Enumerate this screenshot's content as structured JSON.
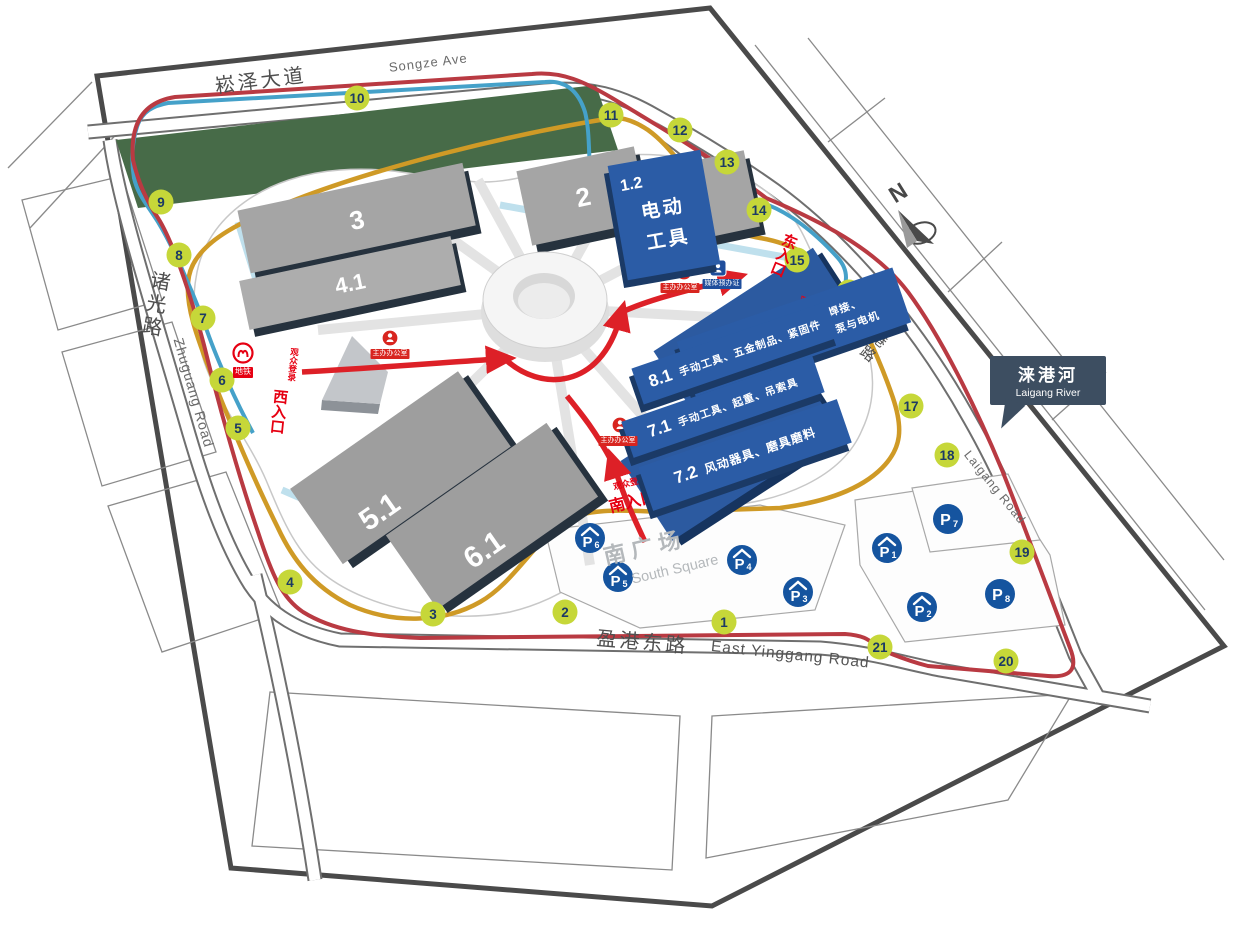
{
  "compass": {
    "n": "N"
  },
  "roads": {
    "songze_zh": "崧泽大道",
    "songze_en": "Songze Ave",
    "zhuguang_zh": "诸光路",
    "zhuguang_en": "Zhuguang Road",
    "yinggang_zh": "盈港东路",
    "yinggang_en": "East Yinggang Road",
    "laigang_zh": "涞港路",
    "laigang_en": "Laigang Road"
  },
  "river_sign": {
    "zh": "涞港河",
    "en": "Laigang River"
  },
  "south_square": {
    "zh": "南广场",
    "en": "South Square"
  },
  "entrances": {
    "west_small": "观众登录",
    "west_big": "西入口",
    "south_small": "观众登录",
    "south_big": "南入口",
    "east_small": "观众登录",
    "east_big": "东入口"
  },
  "halls": {
    "h1": "1",
    "h2": "2",
    "h3": "3",
    "h41": "4.1",
    "h51": "5.1",
    "h61": "6.1",
    "h12_num": "1.2",
    "h12_line1": "电动",
    "h12_line2": "工具",
    "h82_num": "8.2",
    "h82_line1": "电动工具、机械焊接、",
    "h82_line2": "劳保、园林及清洗设备、泵与电机",
    "h81_num": "8.1",
    "h81_text": "手动工具、五金制品、紧固件",
    "h71_num": "7.1",
    "h71_text": "手动工具、起重、吊索具",
    "h72_num": "7.2",
    "h72_text": "风动器具、磨具磨料"
  },
  "route_markers": [
    "1",
    "2",
    "3",
    "4",
    "5",
    "6",
    "7",
    "8",
    "9",
    "10",
    "11",
    "12",
    "13",
    "14",
    "15",
    "16",
    "17",
    "18",
    "19",
    "20",
    "21"
  ],
  "parking": [
    {
      "letter": "P",
      "n": "1",
      "covered": true
    },
    {
      "letter": "P",
      "n": "2",
      "covered": true
    },
    {
      "letter": "P",
      "n": "3",
      "covered": true
    },
    {
      "letter": "P",
      "n": "4",
      "covered": true
    },
    {
      "letter": "P",
      "n": "5",
      "covered": true
    },
    {
      "letter": "P",
      "n": "6",
      "covered": true
    },
    {
      "letter": "P",
      "n": "7",
      "covered": false
    },
    {
      "letter": "P",
      "n": "8",
      "covered": false
    }
  ],
  "poi": {
    "metro_label": "地铁",
    "office_label": "主办办公室",
    "media_label": "媒体预办证"
  },
  "colors": {
    "marker": "#c6d739",
    "parking": "#15549f",
    "hall_highlight": "#2b5ca6",
    "route_red": "#b93a42",
    "route_gold": "#cf9a26",
    "route_blue": "#45a1c9",
    "entrance_red": "#e02227",
    "park_green": "#476b48"
  }
}
